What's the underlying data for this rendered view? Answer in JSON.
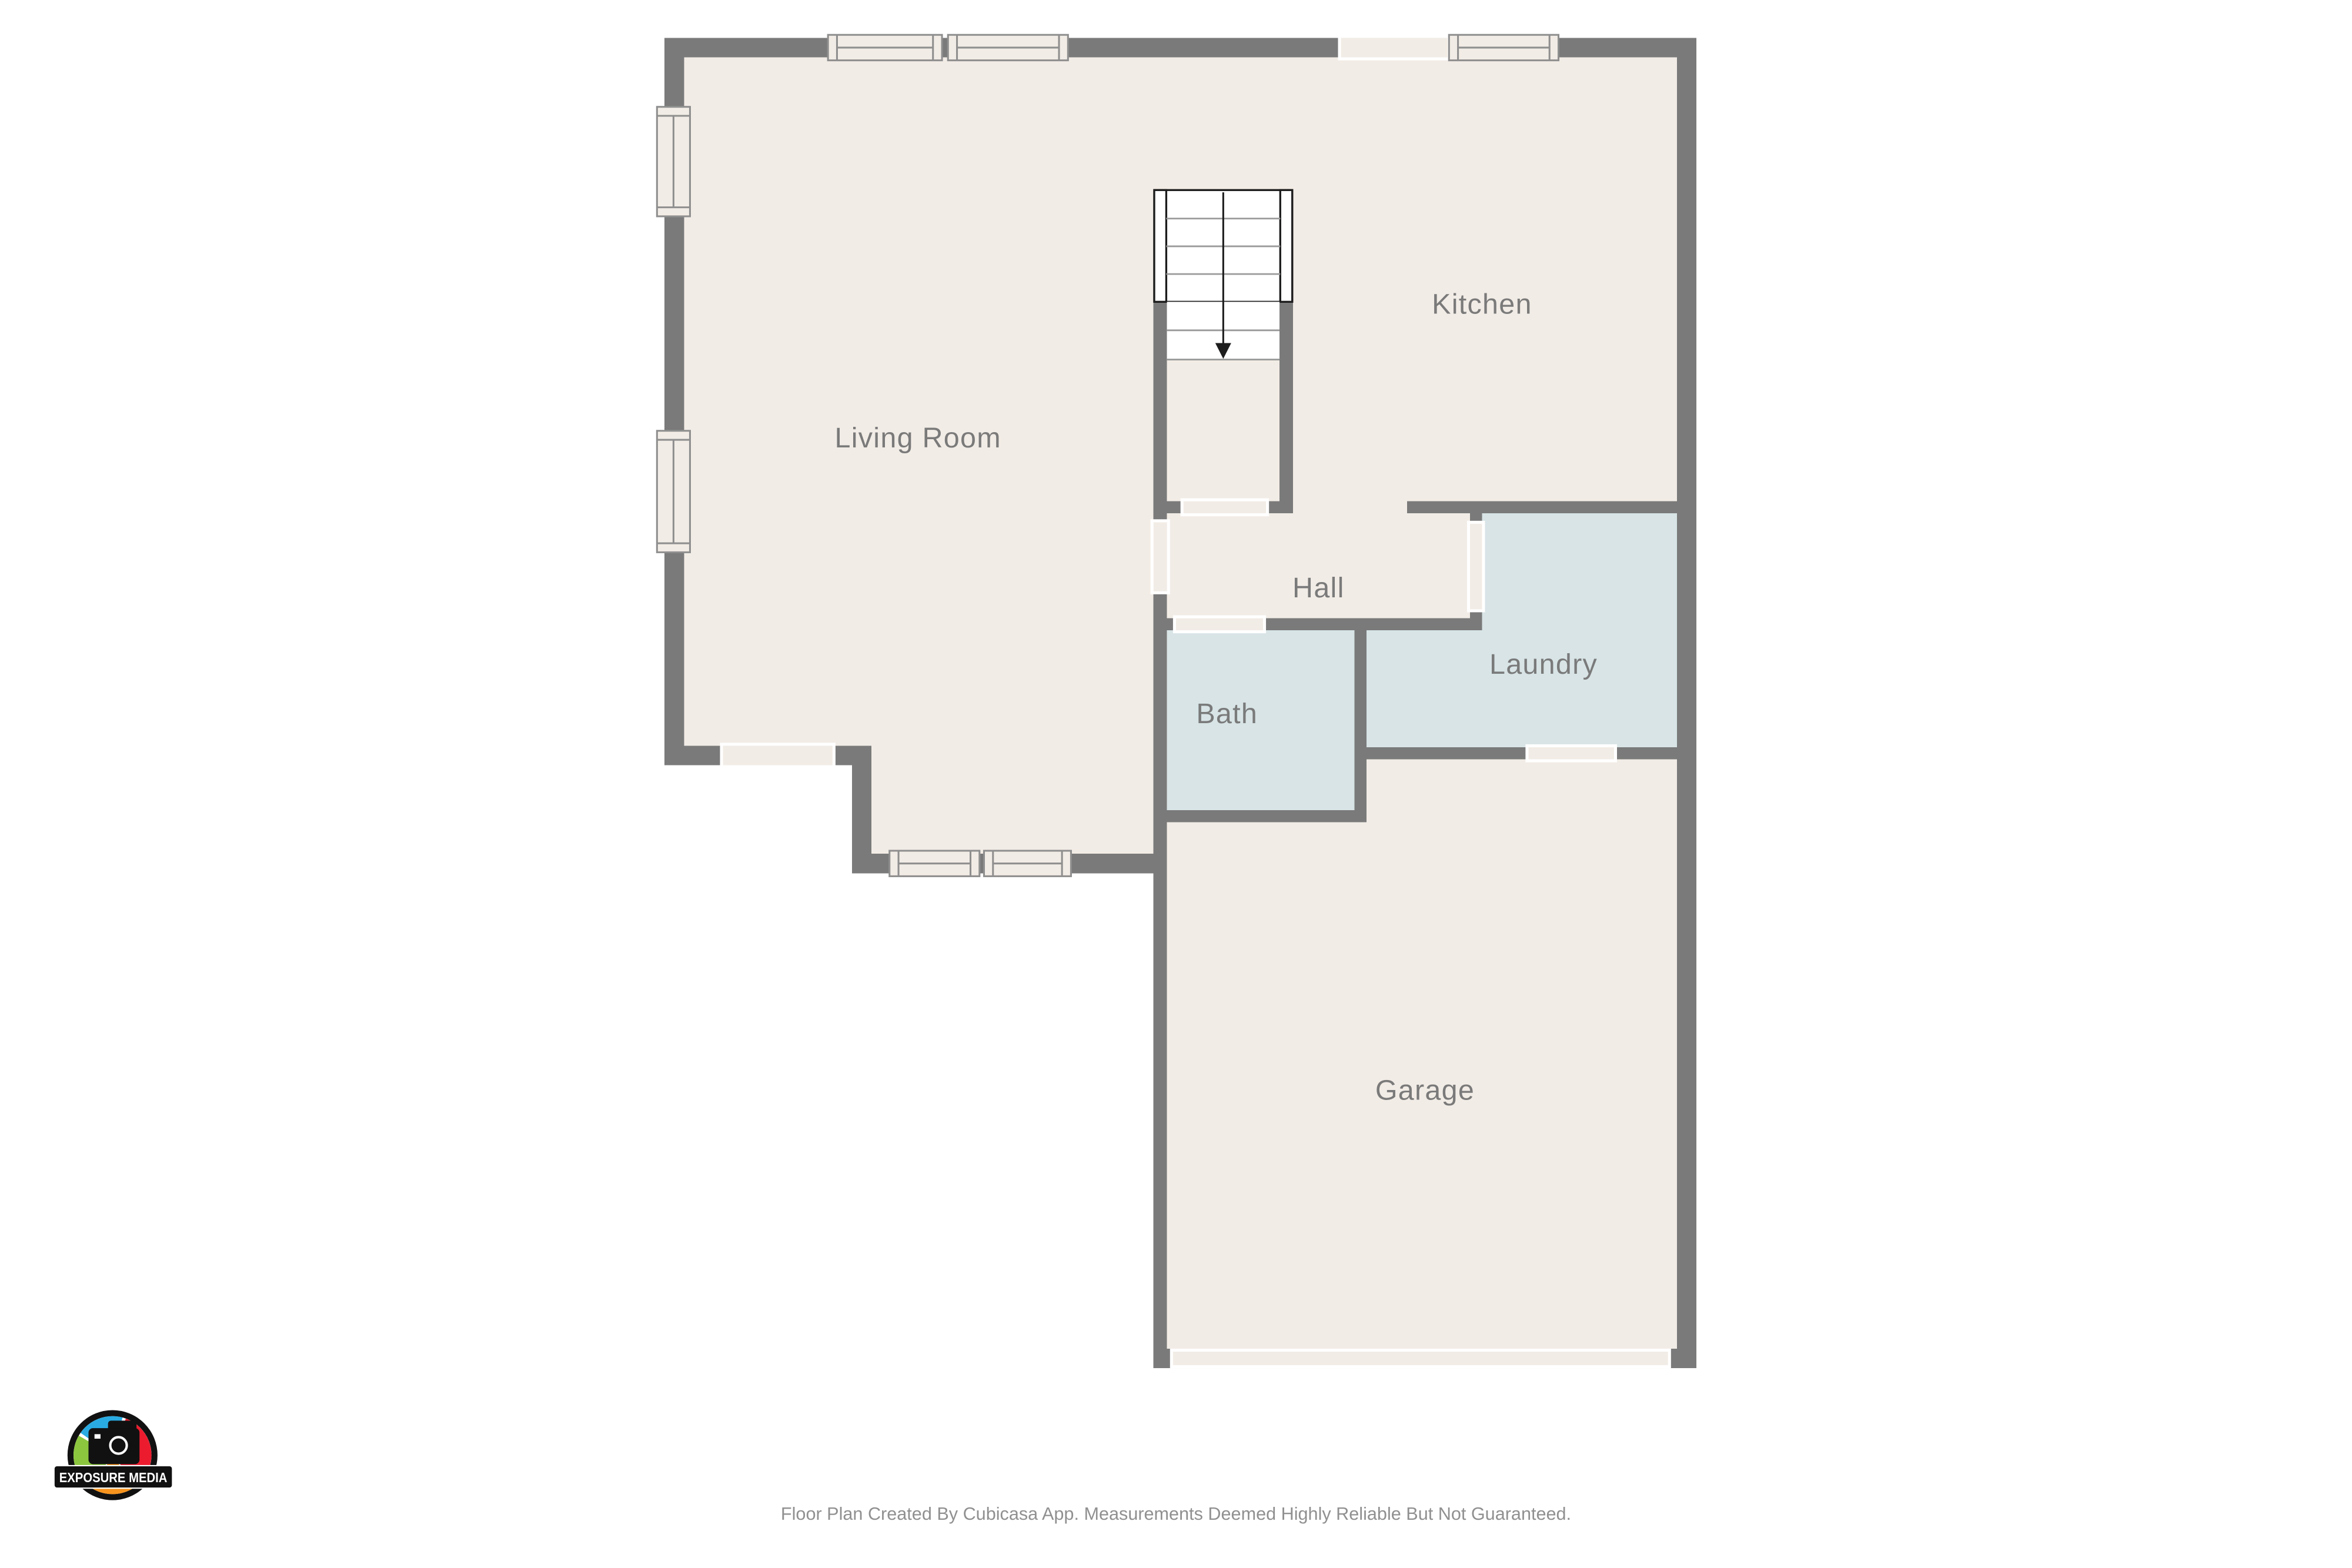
{
  "colors": {
    "floor": "#f2ece6",
    "wet_room": "#d8e4e6",
    "wall": "#7a7a7a",
    "window_frame": "#8f8f8f",
    "room_label": "#7a7a7a",
    "footer_text": "#909090",
    "stair_outline": "#1d1d1d",
    "logo_blue": "#29abe2",
    "logo_red": "#ec1c2e",
    "logo_orange": "#f7941e",
    "logo_green": "#8cc63f",
    "logo_black": "#111111"
  },
  "rooms": [
    {
      "id": "living-room",
      "label": "Living Room"
    },
    {
      "id": "kitchen",
      "label": "Kitchen"
    },
    {
      "id": "hall",
      "label": "Hall"
    },
    {
      "id": "laundry",
      "label": "Laundry"
    },
    {
      "id": "bath",
      "label": "Bath"
    },
    {
      "id": "garage",
      "label": "Garage"
    }
  ],
  "stairs": {
    "type": "straight-staircase",
    "direction": "down"
  },
  "branding": {
    "logo_text": "EXPOSURE MEDIA"
  },
  "footer": {
    "disclaimer": "Floor Plan Created By Cubicasa App. Measurements Deemed Highly Reliable But Not Guaranteed."
  }
}
